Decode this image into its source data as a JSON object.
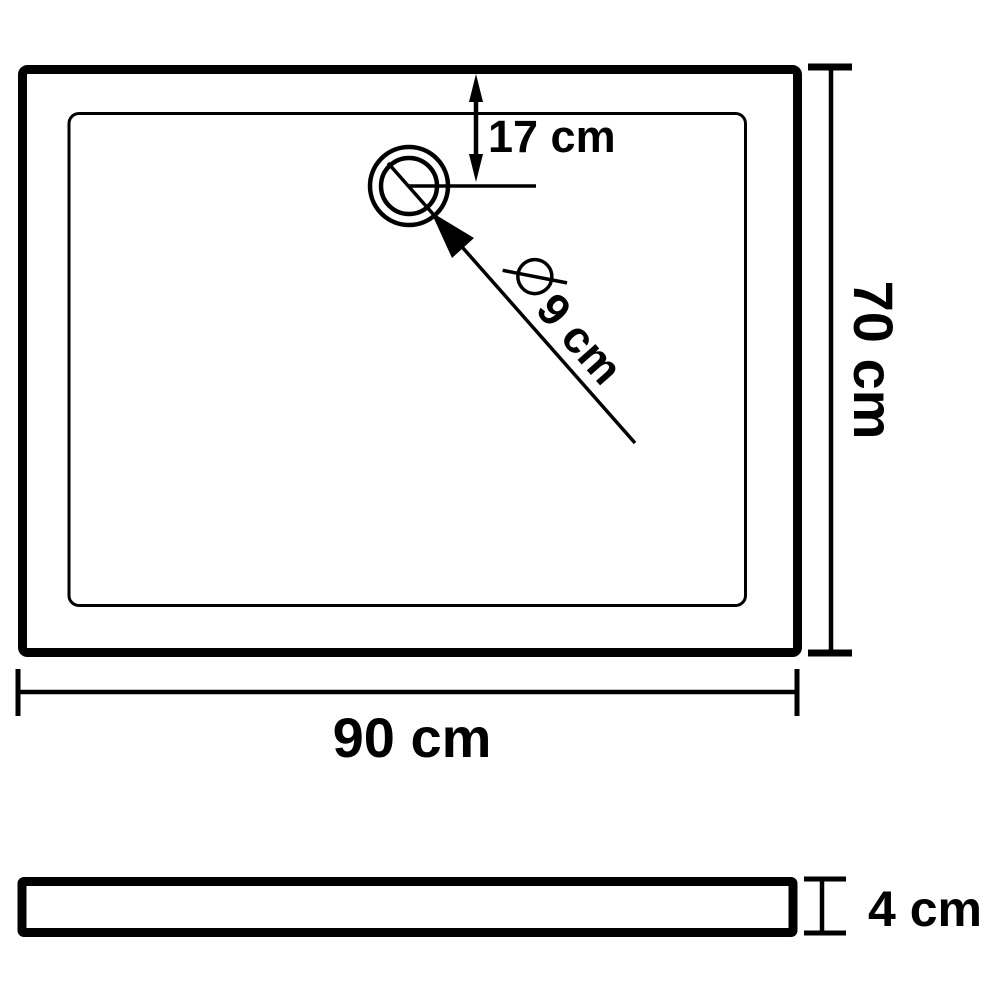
{
  "diagram": {
    "background_color": "#ffffff",
    "line_color": "#000000",
    "icons": {
      "diameter_symbol": "⌀",
      "up_arrowhead": "▲",
      "down_arrowhead": "▼",
      "leader_arrowhead": "➤"
    },
    "dimensions": {
      "drain_offset": "17 cm",
      "drain_diameter": "9 cm",
      "depth": "70 cm",
      "width": "90 cm",
      "height": "4 cm"
    }
  }
}
